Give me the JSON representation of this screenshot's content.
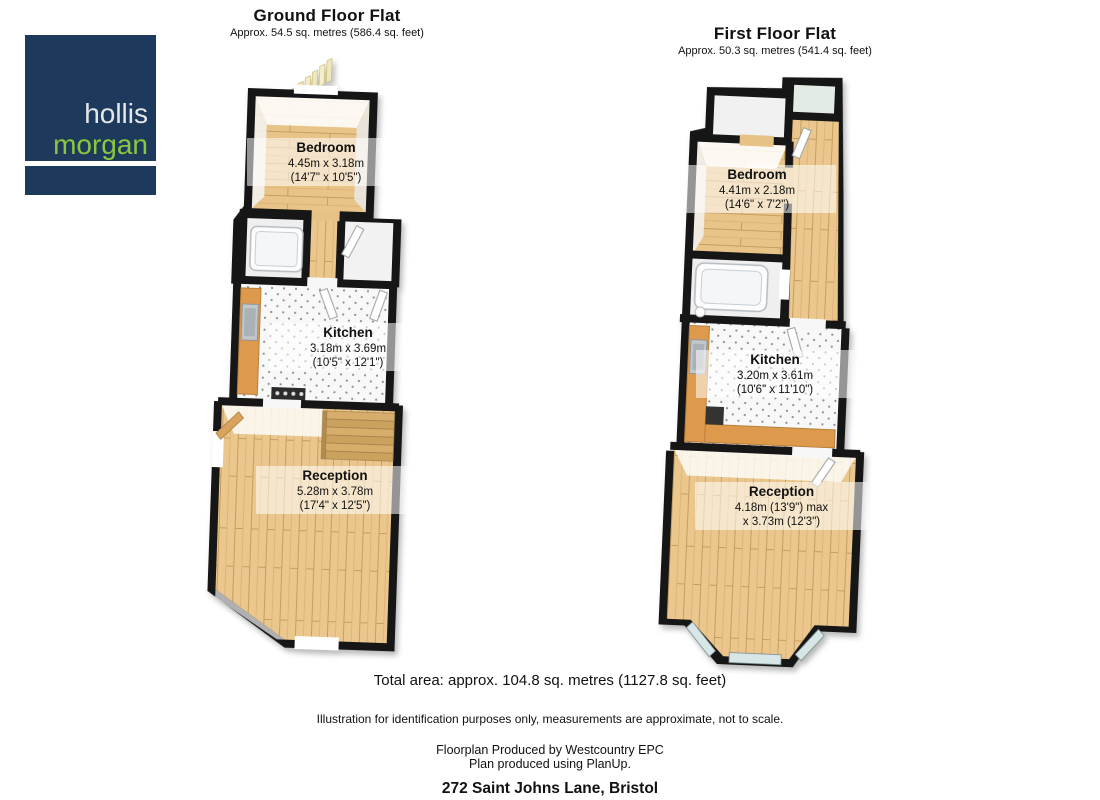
{
  "logo": {
    "word1": "hollis",
    "word2": "morgan",
    "navy": "#1d3a5c",
    "green": "#8cc63e"
  },
  "ground_floor": {
    "title": "Ground Floor Flat",
    "subtitle": "Approx. 54.5 sq. metres (586.4 sq. feet)",
    "rooms": {
      "bedroom": {
        "name": "Bedroom",
        "dim1": "4.45m x 3.18m",
        "dim2": "(14'7\" x 10'5\")"
      },
      "kitchen": {
        "name": "Kitchen",
        "dim1": "3.18m x 3.69m",
        "dim2": "(10'5\" x 12'1\")"
      },
      "reception": {
        "name": "Reception",
        "dim1": "5.28m x 3.78m",
        "dim2": "(17'4\" x 12'5\")"
      }
    }
  },
  "first_floor": {
    "title": "First Floor Flat",
    "subtitle": "Approx. 50.3 sq. metres (541.4 sq. feet)",
    "rooms": {
      "bedroom": {
        "name": "Bedroom",
        "dim1": "4.41m x 2.18m",
        "dim2": "(14'6\" x 7'2\")"
      },
      "kitchen": {
        "name": "Kitchen",
        "dim1": "3.20m x 3.61m",
        "dim2": "(10'6\" x 11'10\")"
      },
      "reception": {
        "name": "Reception",
        "dim1": "4.18m (13'9\") max",
        "dim2": "x 3.73m (12'3\")"
      }
    }
  },
  "footer": {
    "total_area": "Total area: approx. 104.8 sq. metres (1127.8 sq. feet)",
    "disclaimer": "Illustration for identification purposes only, measurements are approximate, not to scale.",
    "produced_by": "Floorplan Produced by Westcountry EPC",
    "software": "Plan produced using PlanUp.",
    "address": "272 Saint Johns Lane, Bristol"
  },
  "colors": {
    "wall": "#161616",
    "wood": "#ebc78d",
    "counter": "#dd9a4c",
    "window": "#d7e6e6",
    "kitchen_floor": "#f8f8f8"
  }
}
